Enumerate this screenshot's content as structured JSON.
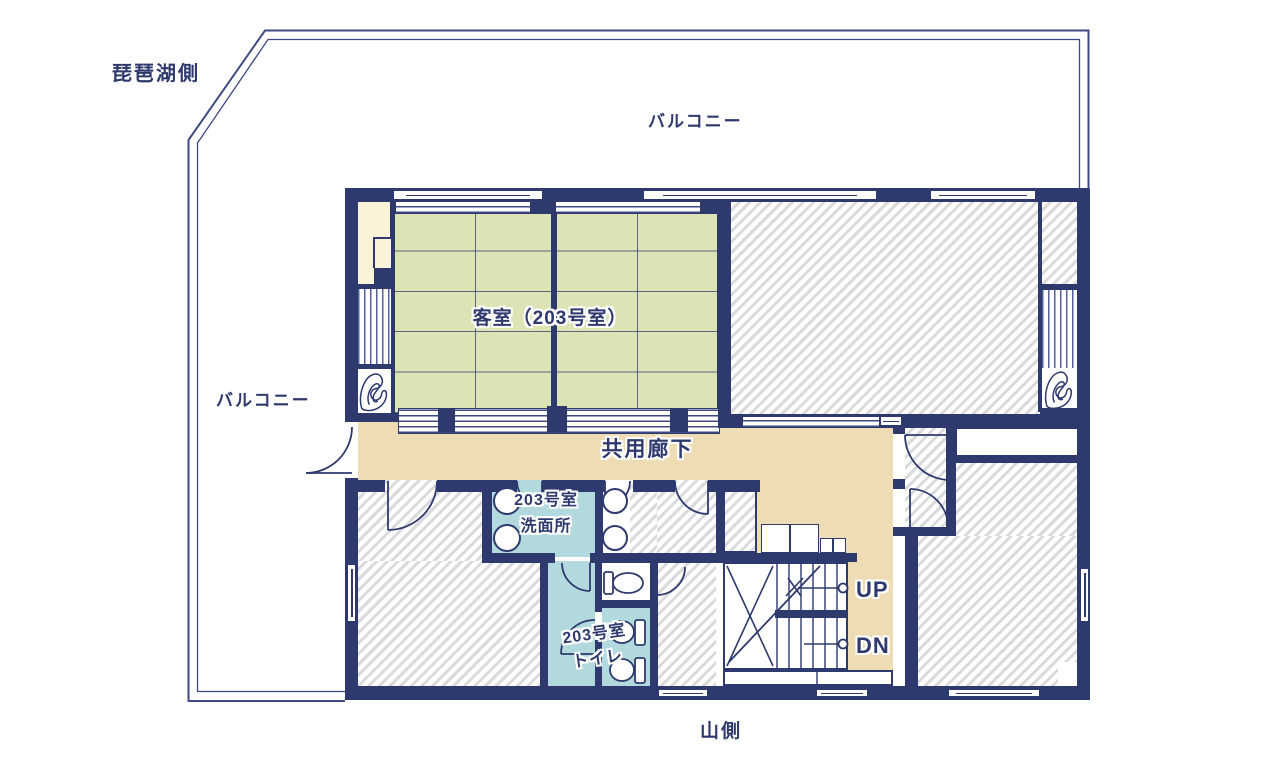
{
  "plan": {
    "title_context": "2F floor plan",
    "orientation": {
      "lake_side": "琵琶湖側",
      "mountain_side": "山側"
    },
    "balcony": {
      "top_label": "バルコニー",
      "left_label": "バルコニー"
    },
    "rooms": {
      "guest_room": {
        "name": "客室（203号室）"
      },
      "corridor": {
        "name": "共用廊下"
      },
      "washroom": {
        "line1": "203号室",
        "line2": "洗面所"
      },
      "toilet": {
        "line1": "203号室",
        "line2": "トイレ"
      }
    },
    "stairs": {
      "up": "UP",
      "down": "DN"
    },
    "fixtures": {
      "washroom_sinks": 2,
      "shared_washroom_sinks": 2,
      "toilet_room_toilets": 2,
      "single_toilet_room_toilets": 1
    },
    "colors": {
      "wall_navy": "#2e3a6e",
      "tatami_green": "#dce4b6",
      "corridor_beige": "#eedcb4",
      "water_blue": "#b2d9de",
      "tokonoma_cream": "#faf3da",
      "hatch_gray": "#d9dade",
      "background": "#ffffff"
    }
  }
}
